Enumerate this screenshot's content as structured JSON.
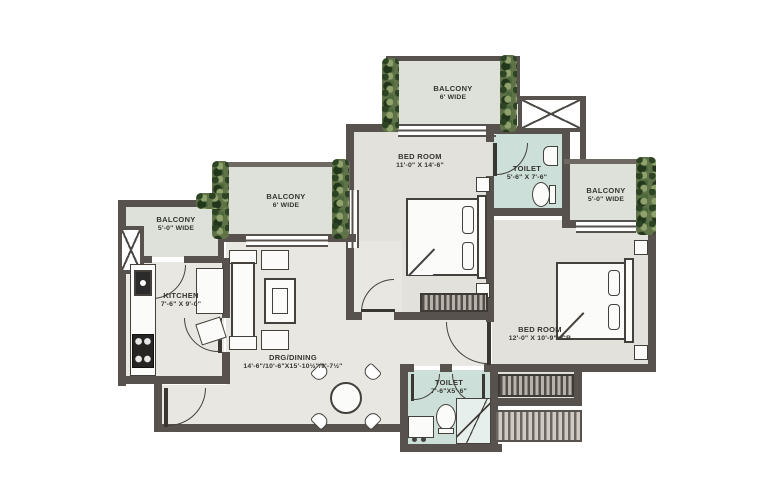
{
  "plan_title": "2 BHK Floor Plan",
  "colors": {
    "wall": "#57524d",
    "room_floor": "#e8e7e2",
    "bedroom_floor": "#e2e1dc",
    "toilet_floor": "#ccdfd9",
    "balcony_floor": "#dde1d9",
    "plants_green": "#5f7248"
  },
  "rooms": {
    "balcony_top": {
      "name": "BALCONY",
      "dim": "6' WIDE"
    },
    "bedroom_1": {
      "name": "BED ROOM",
      "dim": "11'-0\" X 14'-6\""
    },
    "toilet_1": {
      "name": "TOILET",
      "dim": "5'-6\" X 7'-6\""
    },
    "balcony_right": {
      "name": "BALCONY",
      "dim": "5'-0\" WIDE"
    },
    "balcony_mid": {
      "name": "BALCONY",
      "dim": "6' WIDE"
    },
    "balcony_left": {
      "name": "BALCONY",
      "dim": "5'-0\" WIDE"
    },
    "kitchen": {
      "name": "KITCHEN",
      "dim": "7'-6\" X 9'-0\""
    },
    "living": {
      "name": "DRG/DINING",
      "dim": "14'-6\"/10'-6\"X15'-10½\"/9'-7½\""
    },
    "bedroom_2": {
      "name": "BED ROOM",
      "dim": "12'-0\" X 10'-9\"+CB"
    },
    "toilet_2": {
      "name": "TOILET",
      "dim": "7'-6\"X5'-6\""
    }
  }
}
